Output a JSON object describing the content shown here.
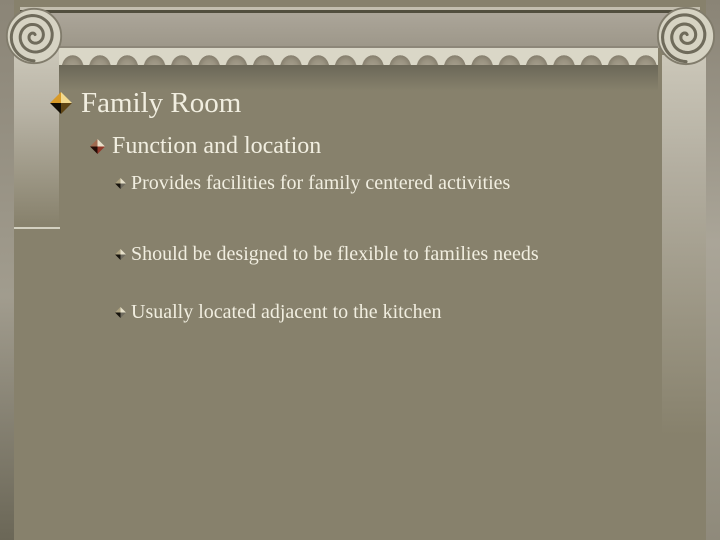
{
  "slide": {
    "title": "Family Room",
    "bullets": [
      {
        "level": 2,
        "text": "Function and location"
      },
      {
        "level": 3,
        "text": "Provides facilities for family centered activities"
      },
      {
        "level": 3,
        "text": "Should be designed to be flexible to families needs"
      },
      {
        "level": 3,
        "text": "Usually located adjacent to the kitchen"
      }
    ],
    "theme": {
      "name": "ionic-column",
      "background": "#87816c",
      "text_color": "#f1eee0",
      "frieze": "#a39d8d",
      "molding_light": "#dad7c7",
      "scallop": "#9a9381",
      "shadow": "#6b6758",
      "column_light": "#cbc7b9",
      "volute_face": "#d6d3c3",
      "spiral_line": "#6f6b5b",
      "title_bullet": {
        "top_left": "#d89a28",
        "top_right": "#f2d98e",
        "bottom_left": "#120e05",
        "bottom_right": "#5e4413"
      },
      "l2_bullet": {
        "top_left": "#a06a50",
        "top_right": "#e9e0ca",
        "bottom_left": "#230c06",
        "bottom_right": "#93392a"
      },
      "l3_bullet": {
        "top_left": "#aba07f",
        "top_right": "#e6e0ca",
        "bottom_left": "#16130c",
        "bottom_right": "#6f6b5f"
      }
    }
  }
}
